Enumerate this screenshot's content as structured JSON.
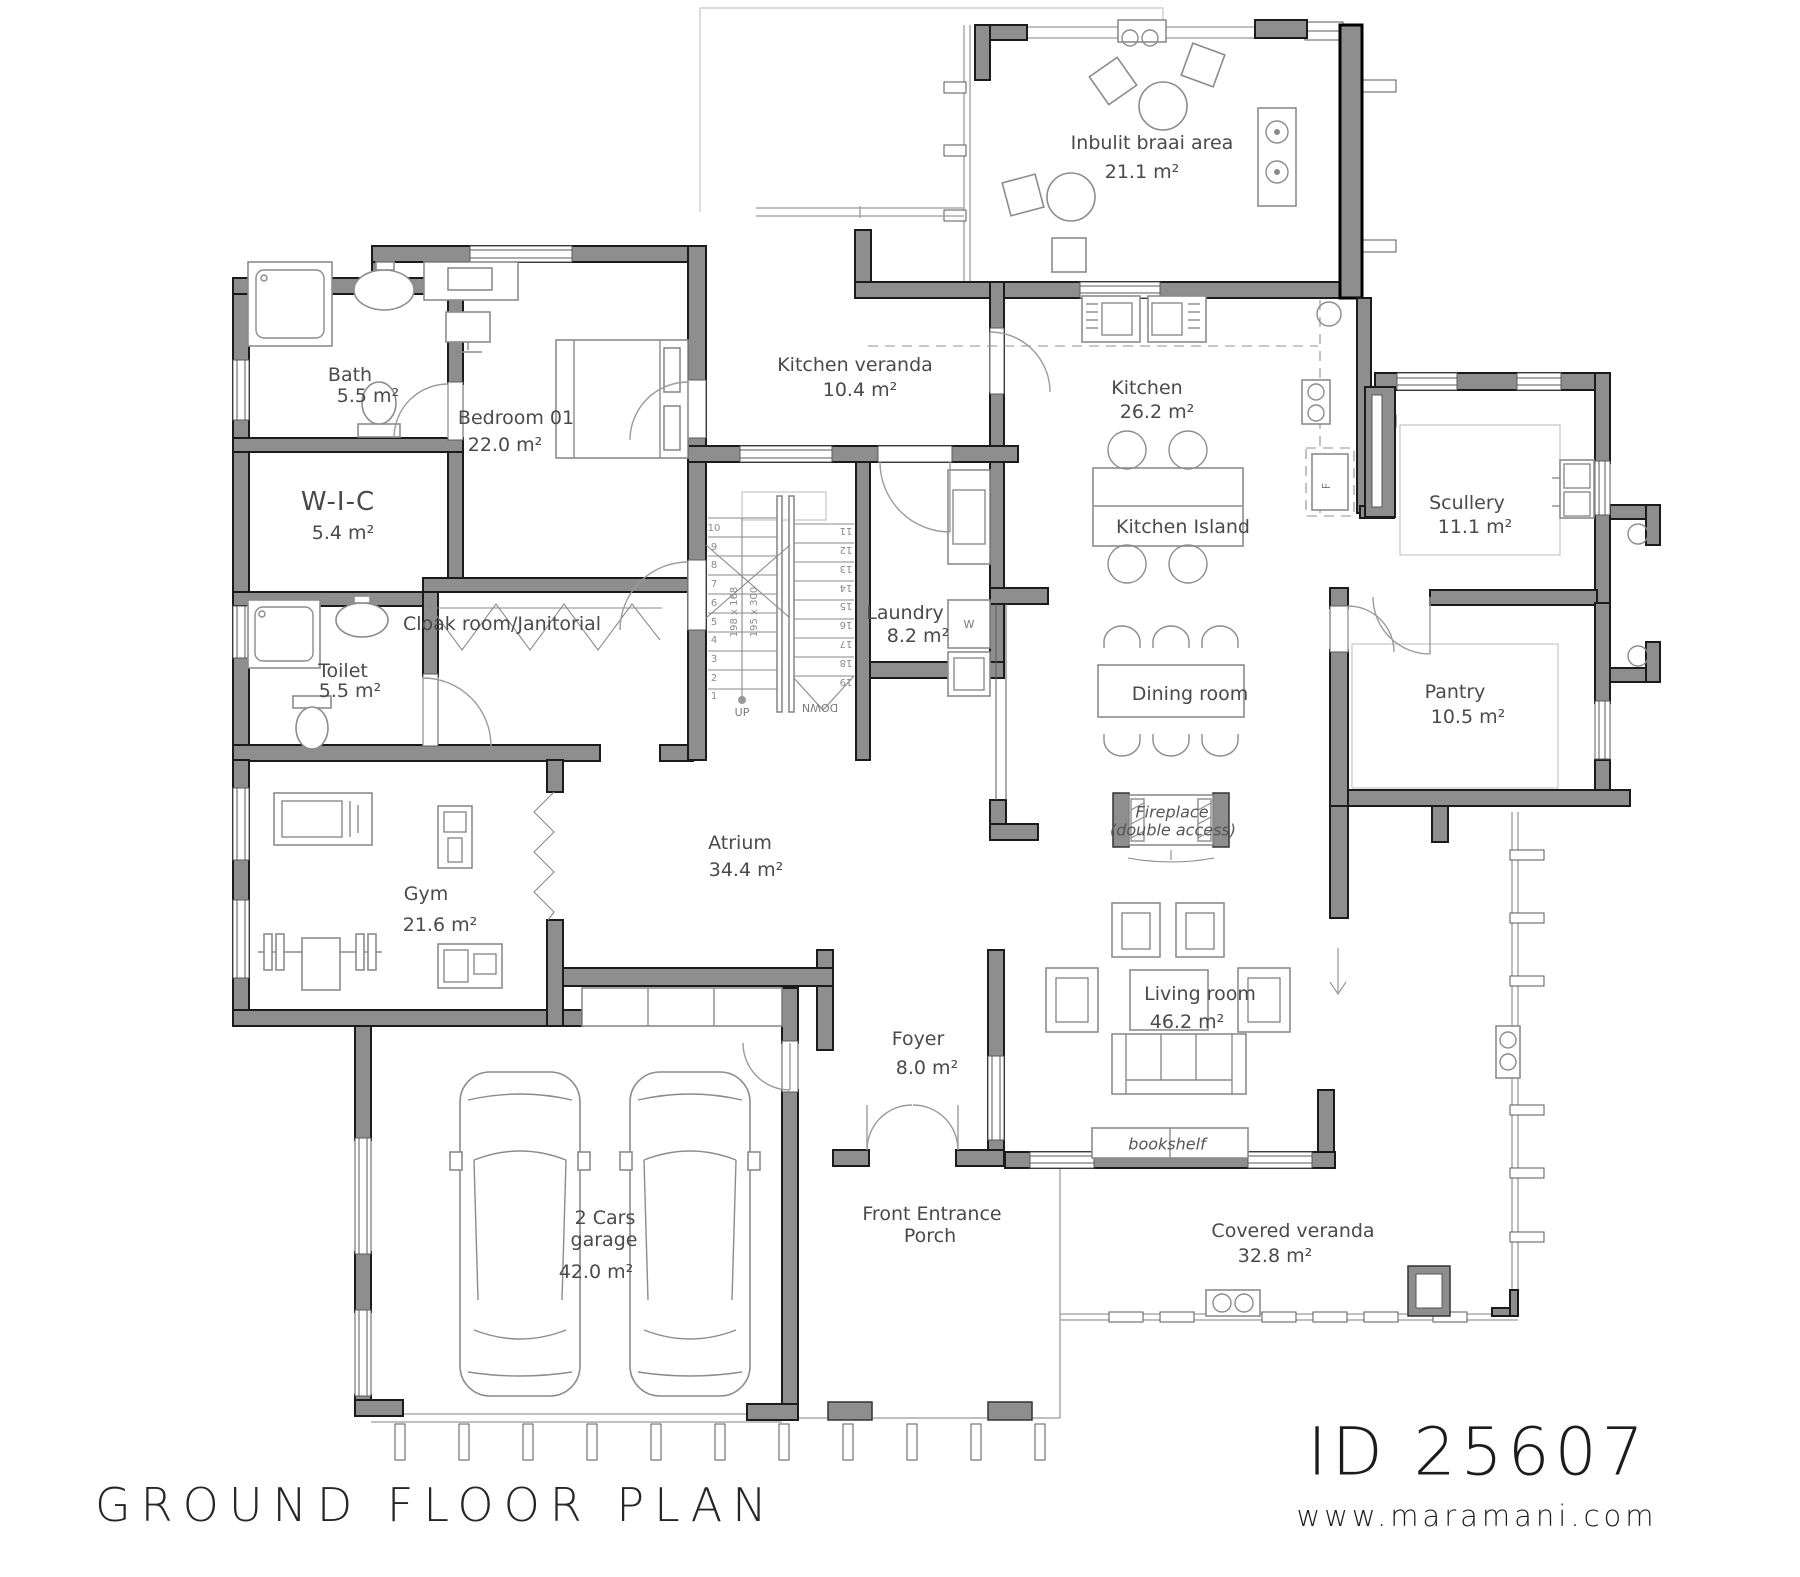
{
  "meta": {
    "floor_title": "GROUND FLOOR PLAN",
    "plan_id": "ID 25607",
    "website": "www.maramani.com"
  },
  "rooms": {
    "braai": {
      "name": "Inbulit braai area",
      "area": "21.1 m²"
    },
    "kitchen_veranda": {
      "name": "Kitchen veranda",
      "area": "10.4 m²"
    },
    "kitchen": {
      "name": "Kitchen",
      "area": "26.2 m²"
    },
    "kitchen_island": {
      "name": "Kitchen Island"
    },
    "scullery": {
      "name": "Scullery",
      "area": "11.1 m²"
    },
    "pantry": {
      "name": "Pantry",
      "area": "10.5 m²"
    },
    "bath": {
      "name": "Bath",
      "area": "5.5 m²"
    },
    "bedroom": {
      "name": "Bedroom 01",
      "area": "22.0 m²"
    },
    "wic": {
      "name": "W-I-C",
      "area": "5.4 m²"
    },
    "cloak": {
      "name": "Cloak room/Janitorial"
    },
    "laundry": {
      "name": "Laundry",
      "area": "8.2 m²"
    },
    "toilet": {
      "name": "Toilet",
      "area": "5.5 m²"
    },
    "dining": {
      "name": "Dining room"
    },
    "fireplace": {
      "name": "Fireplace",
      "note": "(double access)"
    },
    "gym": {
      "name": "Gym",
      "area": "21.6 m²"
    },
    "atrium": {
      "name": "Atrium",
      "area": "34.4 m²"
    },
    "living": {
      "name": "Living room",
      "area": "46.2 m²"
    },
    "bookshelf": {
      "name": "bookshelf"
    },
    "foyer": {
      "name": "Foyer",
      "area": "8.0 m²"
    },
    "porch": {
      "line1": "Front Entrance",
      "line2": "Porch"
    },
    "garage": {
      "line1": "2 Cars",
      "line2": "garage",
      "area": "42.0 m²"
    },
    "covered_veranda": {
      "name": "Covered veranda",
      "area": "32.8 m²"
    }
  },
  "stairs": {
    "up": "UP",
    "down": "DOWN",
    "dim_left": "198 x 168",
    "dim_right": "195 x 300",
    "left_numbers": [
      "1",
      "2",
      "3",
      "4",
      "5",
      "6",
      "7",
      "8",
      "9",
      "10"
    ],
    "right_numbers": [
      "11",
      "12",
      "13",
      "14",
      "15",
      "16",
      "17",
      "18",
      "19"
    ]
  },
  "appliances": {
    "fridge": "F",
    "washer": "W"
  },
  "colors": {
    "wall": "#8e8e8e",
    "wall_outline": "#1b1b1b",
    "text": "#4a4a4a",
    "title": "#1c1c1c"
  }
}
